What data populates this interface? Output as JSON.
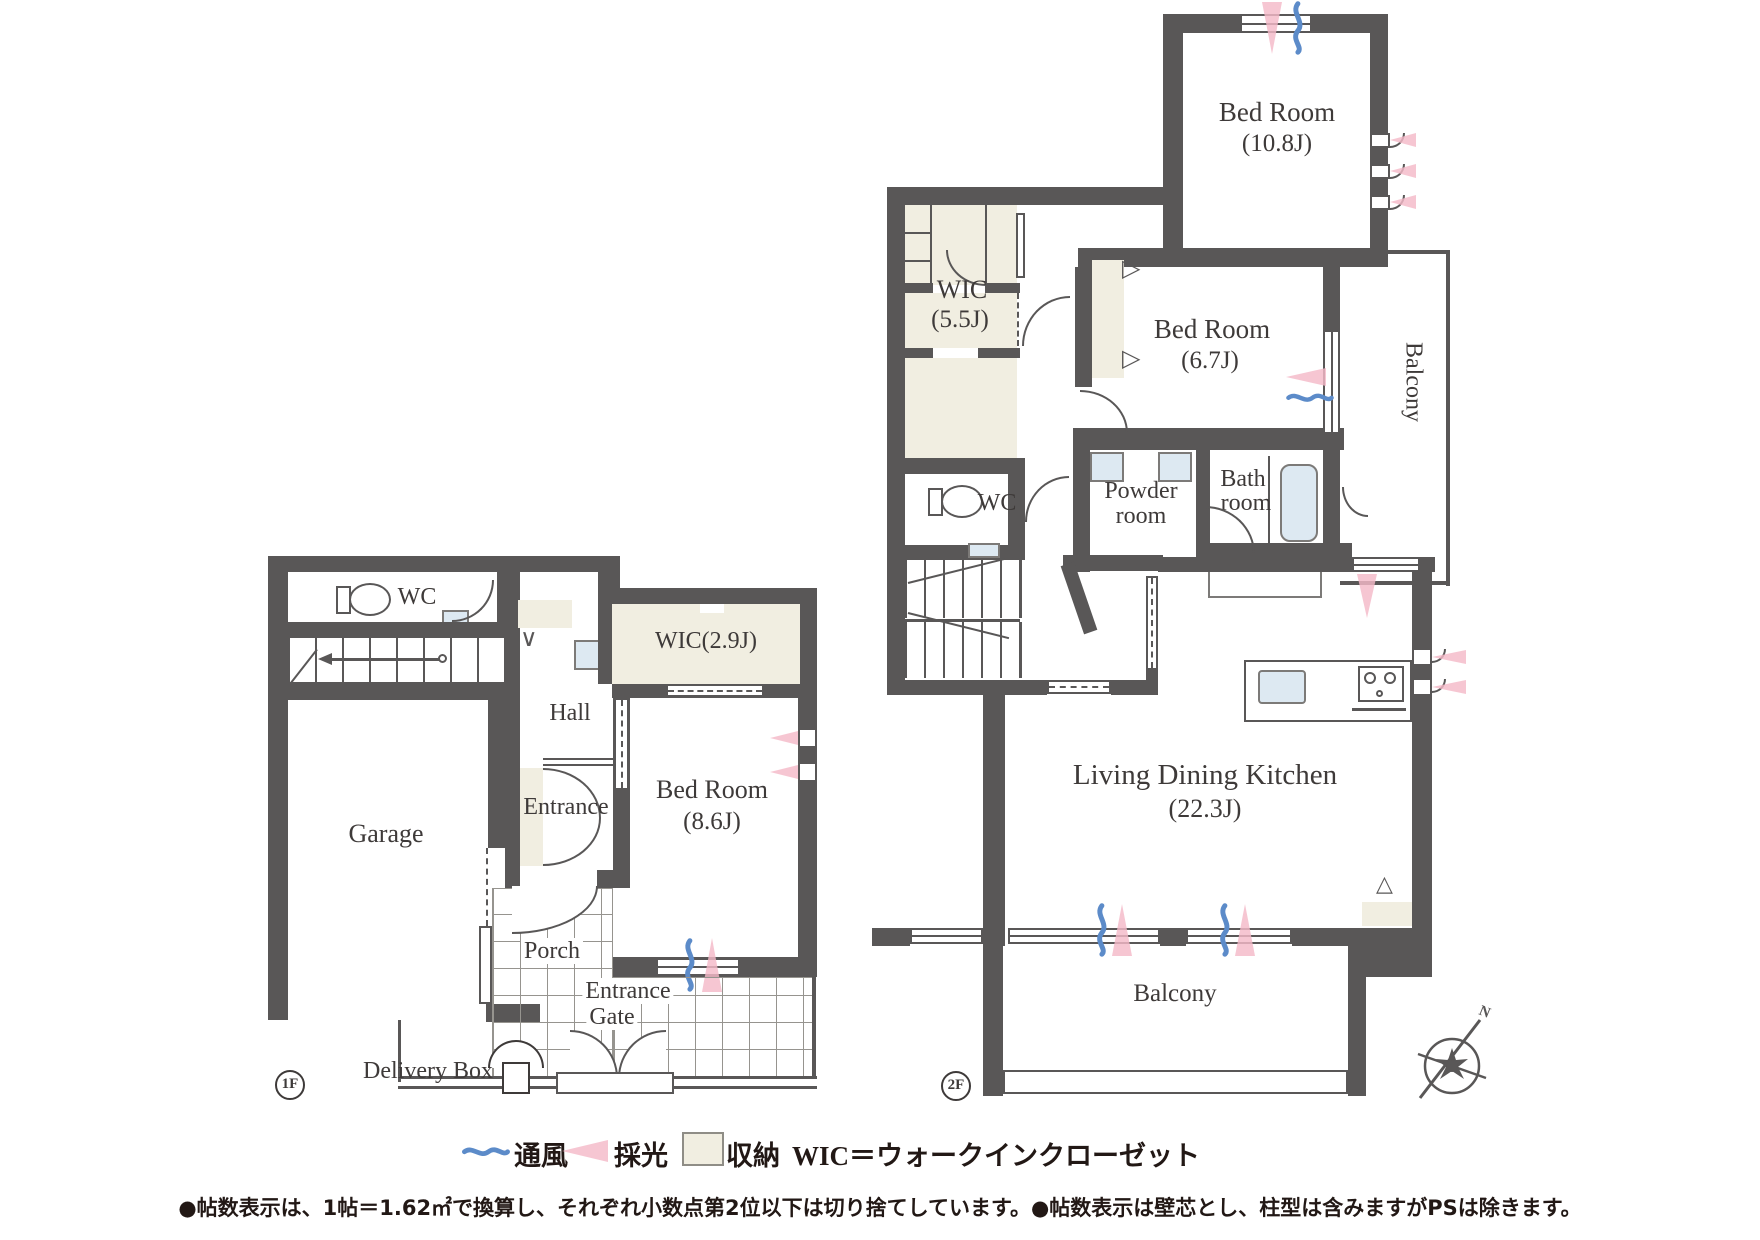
{
  "floor1": {
    "badge": "1F",
    "rooms": {
      "garage": "Garage",
      "wc": "WC",
      "hall": "Hall",
      "entrance": "Entrance",
      "wic": "WIC(2.9J)",
      "bedroom_name": "Bed Room",
      "bedroom_area": "(8.6J)",
      "porch": "Porch",
      "gate_line1": "Entrance",
      "gate_line2": "Gate",
      "delivery": "Delivery Box"
    }
  },
  "floor2": {
    "badge": "2F",
    "rooms": {
      "bedroom_l_name": "Bed Room",
      "bedroom_l_area": "(10.8J)",
      "bedroom_s_name": "Bed Room",
      "bedroom_s_area": "(6.7J)",
      "wic_name": "WIC",
      "wic_area": "(5.5J)",
      "wc": "WC",
      "powder_line1": "Powder",
      "powder_line2": "room",
      "bath_line1": "Bath",
      "bath_line2": "room",
      "balcony_side": "Balcony",
      "ldk_name": "Living Dining K​itchen",
      "ldk_area": "(22.3J)",
      "balcony_bottom": "Balcony"
    }
  },
  "compass": {
    "north": "N"
  },
  "legend": {
    "vent": "通風",
    "daylight": "採光",
    "storage": "収納",
    "wic_definition": "WIC＝ウォークインクローゼット"
  },
  "notes": "●帖数表示は、1帖＝1.62㎡で換算し、それぞれ小数点第2位以下は切り捨てしています。●帖数表示は壁芯とし、柱型は含みますがPSは除きます。",
  "colors": {
    "wall": "#595757",
    "storage_fill": "#f1eee1",
    "fixture_fill": "#dde9f2",
    "daylight_pink": "#f4b9c8",
    "vent_blue": "#5c8bc9"
  }
}
